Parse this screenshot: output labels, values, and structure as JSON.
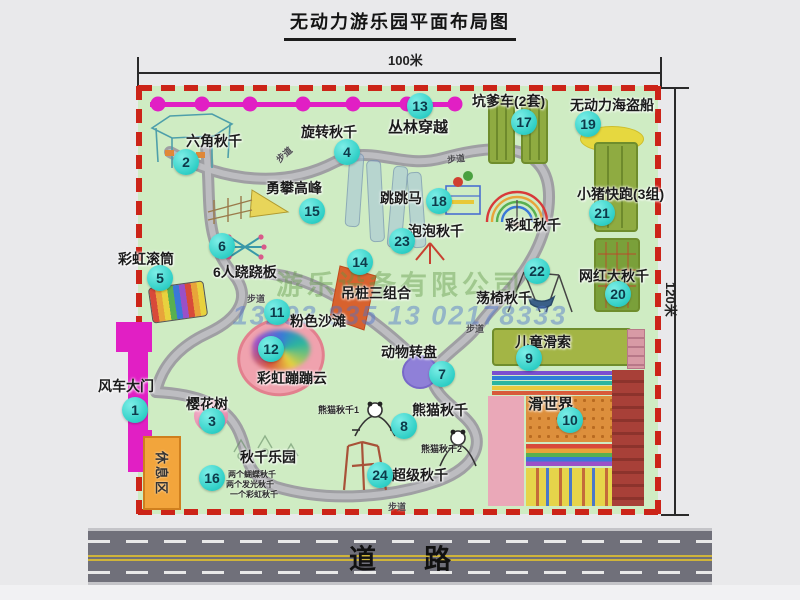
{
  "title": "无动力游乐园平面布局图",
  "dimensions": {
    "width_label": "100米",
    "height_label": "120米"
  },
  "road": {
    "label": "道路"
  },
  "rest_area": {
    "label": "休息区"
  },
  "watermark": {
    "company": "游乐设备有限公司",
    "phone": "13293 835 13 02178333"
  },
  "colors": {
    "badge": "#2fcfc6",
    "border_dash": "#cc2418",
    "gate": "#e11fc4",
    "park_green": "#cfecc3",
    "path_gray": "#a5a5a9"
  },
  "attractions": [
    {
      "num": "1",
      "label": "风车大门",
      "lx": 98,
      "ly": 376,
      "ls": 14,
      "bx": 135,
      "by": 410
    },
    {
      "num": "2",
      "label": "六角秋千",
      "lx": 186,
      "ly": 131,
      "ls": 14,
      "bx": 186,
      "by": 162
    },
    {
      "num": "3",
      "label": "樱花树",
      "lx": 186,
      "ly": 394,
      "ls": 14,
      "bx": 212,
      "by": 421
    },
    {
      "num": "4",
      "label": "旋转秋千",
      "lx": 301,
      "ly": 122,
      "ls": 14,
      "bx": 347,
      "by": 152
    },
    {
      "num": "5",
      "label": "彩虹滚筒",
      "lx": 118,
      "ly": 249,
      "ls": 14,
      "bx": 160,
      "by": 278
    },
    {
      "num": "6",
      "label": "6人跷跷板",
      "lx": 213,
      "ly": 262,
      "ls": 14,
      "bx": 222,
      "by": 246
    },
    {
      "num": "7",
      "label": "动物转盘",
      "lx": 381,
      "ly": 342,
      "ls": 14,
      "bx": 442,
      "by": 374
    },
    {
      "num": "8",
      "label": "熊猫秋千",
      "lx": 412,
      "ly": 400,
      "ls": 14,
      "bx": 404,
      "by": 426
    },
    {
      "num": "9",
      "label": "儿童滑索",
      "lx": 515,
      "ly": 332,
      "ls": 14,
      "bx": 529,
      "by": 358
    },
    {
      "num": "10",
      "label": "滑世界",
      "lx": 528,
      "ly": 393,
      "ls": 15,
      "bx": 570,
      "by": 420
    },
    {
      "num": "11",
      "label": "粉色沙滩",
      "lx": 290,
      "ly": 311,
      "ls": 14,
      "bx": 277,
      "by": 312
    },
    {
      "num": "12",
      "label": "彩虹蹦蹦云",
      "lx": 257,
      "ly": 368,
      "ls": 14,
      "bx": 271,
      "by": 349
    },
    {
      "num": "13",
      "label": "丛林穿越",
      "lx": 388,
      "ly": 116,
      "ls": 15,
      "bx": 420,
      "by": 106
    },
    {
      "num": "14",
      "label": "吊桩三组合",
      "lx": 341,
      "ly": 283,
      "ls": 14,
      "bx": 360,
      "by": 262
    },
    {
      "num": "15",
      "label": "勇攀高峰",
      "lx": 266,
      "ly": 178,
      "ls": 14,
      "bx": 312,
      "by": 211
    },
    {
      "num": "16",
      "label": "秋千乐园",
      "lx": 240,
      "ly": 447,
      "ls": 14,
      "bx": 212,
      "by": 478
    },
    {
      "num": "17",
      "label": "坑爹车(2套)",
      "lx": 472,
      "ly": 91,
      "ls": 14,
      "bx": 524,
      "by": 122
    },
    {
      "num": "18",
      "label": "跳跳马",
      "lx": 380,
      "ly": 188,
      "ls": 14,
      "bx": 439,
      "by": 201
    },
    {
      "num": "19",
      "label": "无动力海盗船",
      "lx": 570,
      "ly": 95,
      "ls": 14,
      "bx": 588,
      "by": 124
    },
    {
      "num": "20",
      "label": "网红大秋千",
      "lx": 579,
      "ly": 266,
      "ls": 14,
      "bx": 618,
      "by": 294
    },
    {
      "num": "21",
      "label": "小猪快跑(3组)",
      "lx": 577,
      "ly": 184,
      "ls": 14,
      "bx": 602,
      "by": 213
    },
    {
      "num": "22",
      "label": "荡椅秋千",
      "lx": 476,
      "ly": 288,
      "ls": 14,
      "bx": 537,
      "by": 271
    },
    {
      "num": "23",
      "label": "泡泡秋千",
      "lx": 408,
      "ly": 221,
      "ls": 14,
      "bx": 402,
      "by": 241
    },
    {
      "num": "24",
      "label": "超级秋千",
      "lx": 392,
      "ly": 465,
      "ls": 14,
      "bx": 380,
      "by": 475
    },
    {
      "num": null,
      "label": "彩虹秋千",
      "lx": 505,
      "ly": 215,
      "ls": 14,
      "bx": null,
      "by": null
    }
  ],
  "sub_labels": [
    {
      "text": "熊猫秋千1",
      "x": 318,
      "y": 403,
      "s": 9
    },
    {
      "text": "熊猫秋千2",
      "x": 421,
      "y": 442,
      "s": 9
    },
    {
      "text": "两个蝴蝶秋千",
      "x": 228,
      "y": 469,
      "s": 8
    },
    {
      "text": "两个发光秋千",
      "x": 226,
      "y": 479,
      "s": 8
    },
    {
      "text": "一个彩虹秋千",
      "x": 230,
      "y": 489,
      "s": 8
    }
  ],
  "path_labels": [
    {
      "text": "步道",
      "x": 275,
      "y": 148,
      "r": -42
    },
    {
      "text": "步道",
      "x": 447,
      "y": 152,
      "r": -6
    },
    {
      "text": "步道",
      "x": 247,
      "y": 292,
      "r": 0
    },
    {
      "text": "步道",
      "x": 466,
      "y": 322,
      "r": 0
    },
    {
      "text": "步道",
      "x": 388,
      "y": 500,
      "r": 0
    }
  ]
}
